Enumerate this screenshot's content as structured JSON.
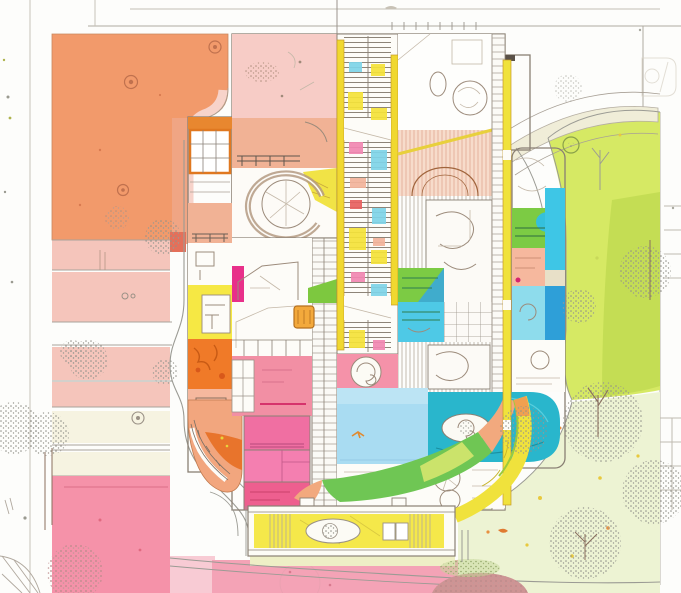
{
  "scene": {
    "kind": "architectural-site-plan",
    "background": "#FDFDFB"
  },
  "palette": {
    "plaza_orange": "#F29A6B",
    "band_pink": "#F5C5BB",
    "band_cream": "#F6F3E1",
    "ground_pink_hot": "#F592A9",
    "ground_pink_south": "#F4A3B6",
    "ground_pink_pale": "#F8CBD4",
    "ground_mauve": "#CE9494",
    "lawn_bright": "#D6E964",
    "lawn_dark": "#C2DC52",
    "lawn_pale": "#EDF3D3",
    "curve_cream": "#F0EDD8",
    "roof_pink": "#F7CCC6",
    "salmon": "#F1B295",
    "salmon_light": "#F6B89E",
    "room_yellow": "#F6E844",
    "room_orange": "#F07A28",
    "frame_orange": "#E8872F",
    "room_green": "#7CCB44",
    "wedge_green": "#7DC83F",
    "room_cyan": "#4EC9E6",
    "room_cyan_light": "#8EDCEC",
    "room_blue": "#2E9FD8",
    "pool_light": "#A9DCF2",
    "pool_teal": "#29B6CC",
    "magenta": "#E8308A",
    "room_pink": "#F28FA4",
    "room_pink_deep": "#F06FA2",
    "room_pink_deep2": "#F47FB0",
    "hot_rose": "#EE5F8F",
    "ribbon_yellow": "#F0E23C",
    "bar_yellow": "#F5E84A",
    "arch_salmon": "#F7DCCB",
    "road_pink": "#F7D3CA",
    "rail_yellow": "#F0D830",
    "green_crescent": "#6FC654",
    "green_crescent_light": "#CBE36B",
    "salmon_crescent": "#F2A97E",
    "sw_salmon": "#F2A67E",
    "sw_orange": "#E8742C"
  }
}
